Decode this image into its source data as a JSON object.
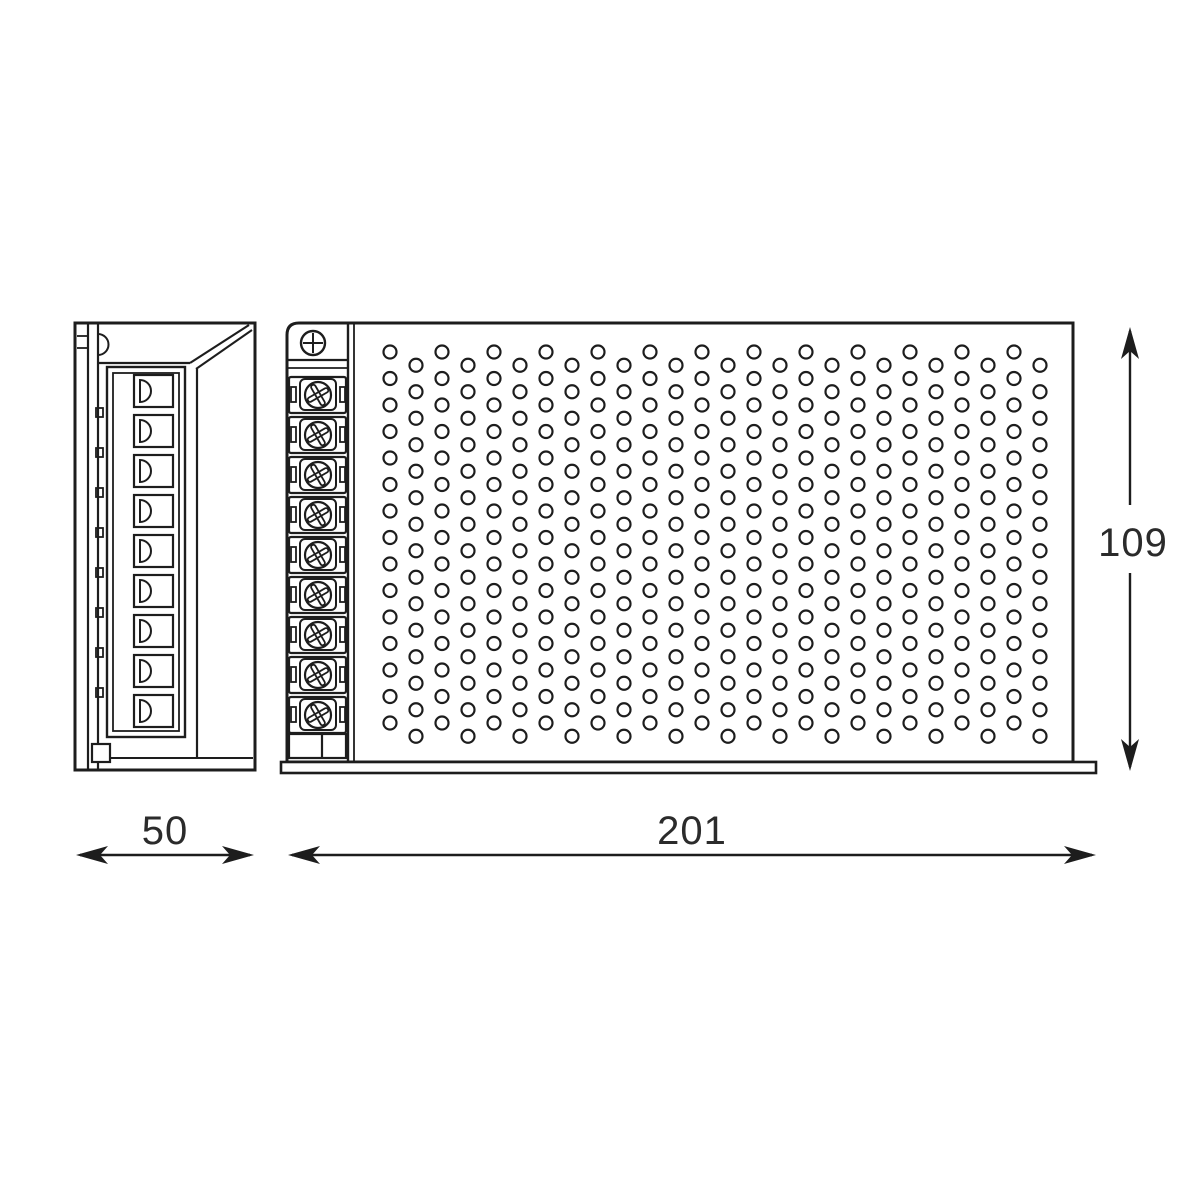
{
  "page": {
    "background": "#ffffff",
    "line_color": "#1d1d1d",
    "text_color": "#2b2b2b"
  },
  "drawing": {
    "type": "technical-dimension-drawing",
    "subject": "perforated power supply enclosure, side view and front view",
    "dimensions": {
      "depth": {
        "label": "50"
      },
      "width": {
        "label": "201"
      },
      "height": {
        "label": "109"
      }
    },
    "side_view": {
      "terminal_slots": 9,
      "first_slot_y": 375,
      "slot_pitch": 40,
      "slot_height": 32
    },
    "front_view": {
      "ground_screw_icon": "plus-screw-icon",
      "terminal_screw_icon": "cross-screw-icon",
      "terminal_count": 9,
      "first_cell_y": 375,
      "cell_pitch": 40
    },
    "perforation": {
      "columns": 26,
      "rows_per_column": 15,
      "pitch_x": 26,
      "pitch_y": 26.5,
      "stagger_offset": 13.25,
      "radius": 6.5,
      "origin_x": 390,
      "origin_y": 352
    }
  }
}
